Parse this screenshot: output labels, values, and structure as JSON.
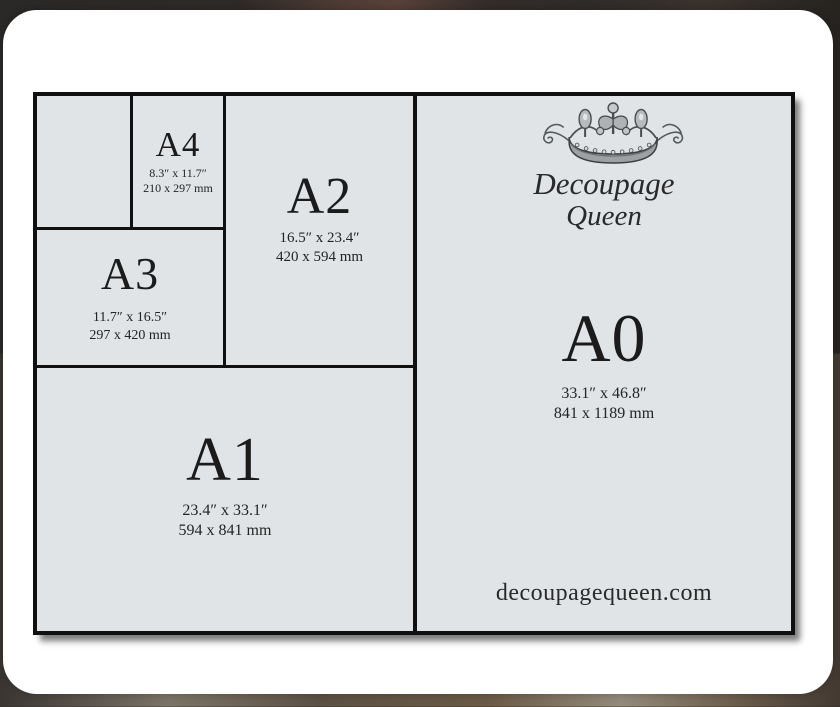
{
  "brand": {
    "name_line1": "Decoupage",
    "name_line2": "Queen",
    "website": "decoupagequeen.com",
    "logo": "crown-icon"
  },
  "diagram": {
    "description": "A-series paper size comparison",
    "sizes": [
      {
        "code": "A4",
        "inches": "8.3″ x 11.7″",
        "mm": "210 x 297 mm"
      },
      {
        "code": "A3",
        "inches": "11.7″ x 16.5″",
        "mm": "297 x 420 mm"
      },
      {
        "code": "A2",
        "inches": "16.5″ x 23.4″",
        "mm": "420 x 594 mm"
      },
      {
        "code": "A1",
        "inches": "23.4″ x 33.1″",
        "mm": "594 x 841 mm"
      },
      {
        "code": "A0",
        "inches": "33.1″ x 46.8″",
        "mm": "841 x 1189 mm"
      }
    ]
  },
  "colors": {
    "panel_fill": "#e0e4e7",
    "line_color": "#101010",
    "text_color": "#1b1b1b",
    "card_fill": "#ffffff"
  }
}
